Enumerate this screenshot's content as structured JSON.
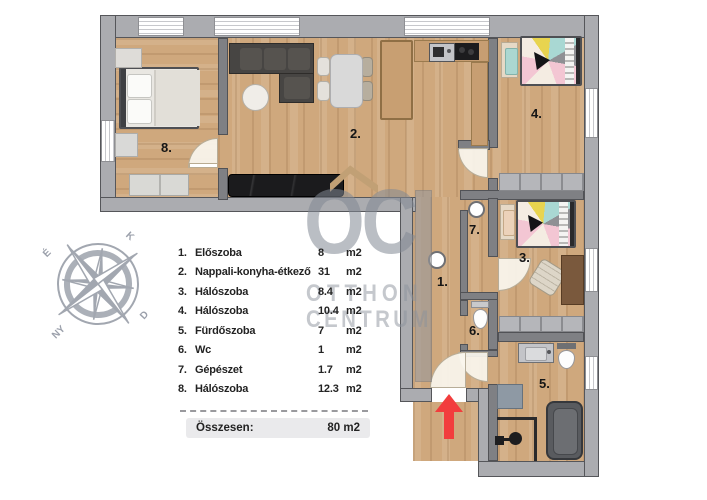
{
  "legend": {
    "items": [
      {
        "num": "1.",
        "label": "Előszoba",
        "value": "8",
        "unit": "m2"
      },
      {
        "num": "2.",
        "label": "Nappali-konyha-étkező",
        "value": "31",
        "unit": "m2"
      },
      {
        "num": "3.",
        "label": "Hálószoba",
        "value": "8.4",
        "unit": "m2"
      },
      {
        "num": "4.",
        "label": "Hálószoba",
        "value": "10.4",
        "unit": "m2"
      },
      {
        "num": "5.",
        "label": "Fürdőszoba",
        "value": "7",
        "unit": "m2"
      },
      {
        "num": "6.",
        "label": "Wc",
        "value": "1",
        "unit": "m2"
      },
      {
        "num": "7.",
        "label": "Gépészet",
        "value": "1.7",
        "unit": "m2"
      },
      {
        "num": "8.",
        "label": "Hálószoba",
        "value": "12.3",
        "unit": "m2"
      }
    ],
    "total_label": "Összesen:",
    "total_value": "80 m2"
  },
  "plan": {
    "room_labels": {
      "r1": "1.",
      "r2": "2.",
      "r3": "3.",
      "r4": "4.",
      "r5": "5.",
      "r6": "6.",
      "r7": "7.",
      "r8": "8."
    }
  },
  "compass": {
    "north": "É",
    "east": "K",
    "south": "D",
    "west": "NY"
  },
  "watermark": {
    "monogram": "OC",
    "line1": "OTTHON",
    "line2": "CENTRUM"
  },
  "colors": {
    "wall_exterior": "#abacb0",
    "wall_interior": "#7f8084",
    "floor_wood": "#cfa87d",
    "entrance_arrow": "#f23d3d",
    "watermark_gray": "#b9bcc2",
    "legend_text": "#232323"
  }
}
